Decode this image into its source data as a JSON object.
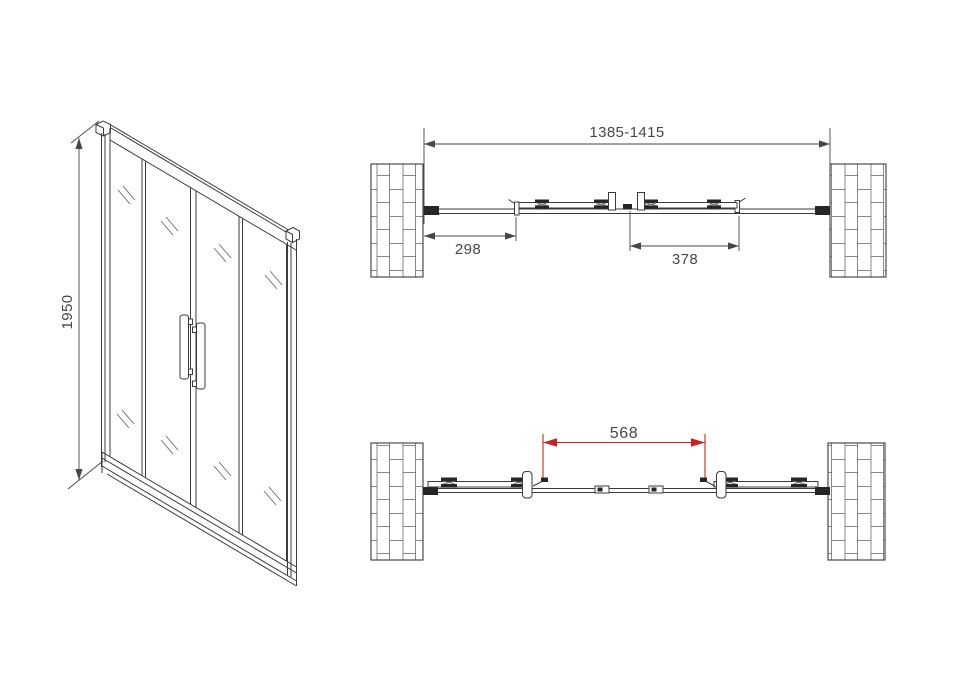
{
  "drawing": {
    "title": "sliding-shower-door-technical-drawing",
    "background": "#ffffff",
    "line_color": "#3b3b3b",
    "text_color": "#474747",
    "accent_color": "#cc2222",
    "front_view": {
      "height_label": "1950"
    },
    "plan_view_closed": {
      "overall_width_label": "1385-1415",
      "left_panel_label": "298",
      "right_panel_label": "378"
    },
    "plan_view_open": {
      "opening_label": "568",
      "opening_label_color": "#cc2222"
    }
  }
}
